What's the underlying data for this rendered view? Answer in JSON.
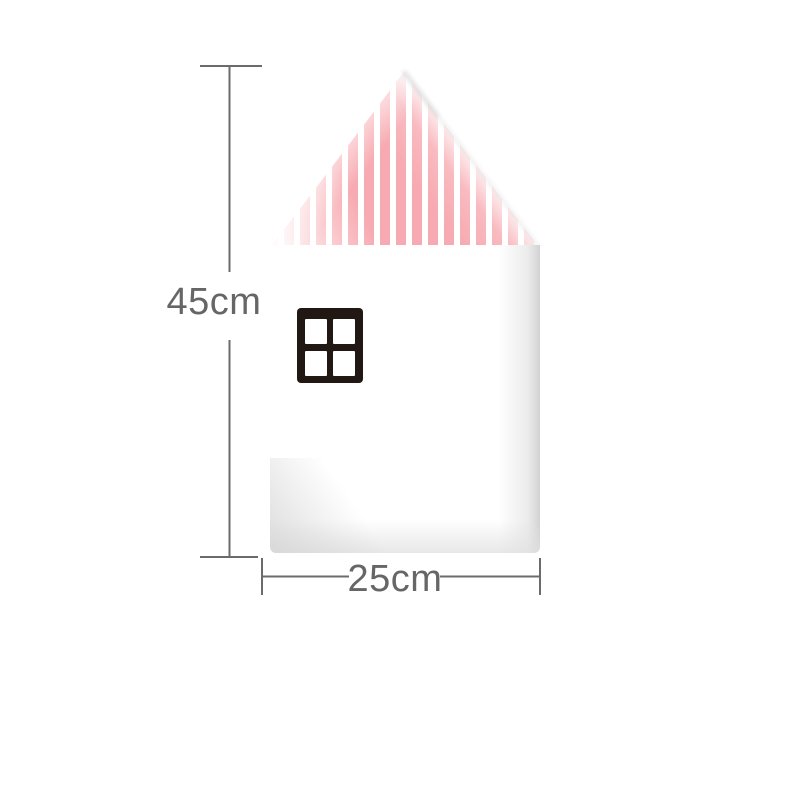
{
  "figure": {
    "kind": "product-dimension-diagram",
    "illustration": {
      "name": "house-shaped-panel",
      "roof_style": "vertical-pink-stripes",
      "window_style": "four-pane-dark-frame"
    }
  },
  "annotations": {
    "height": {
      "label": "45cm"
    },
    "width": {
      "label": "25cm"
    }
  },
  "colors": {
    "background": "#ffffff",
    "stripe-pink": "#f7aab1",
    "roof-white": "#ffffff",
    "body-white": "#ffffff",
    "window-frame": "#221813",
    "window-pane": "#ffffff",
    "dimension-line": "#6b6b6b",
    "label-text": "#666666",
    "shadow-gray": "#d9d9d9"
  }
}
